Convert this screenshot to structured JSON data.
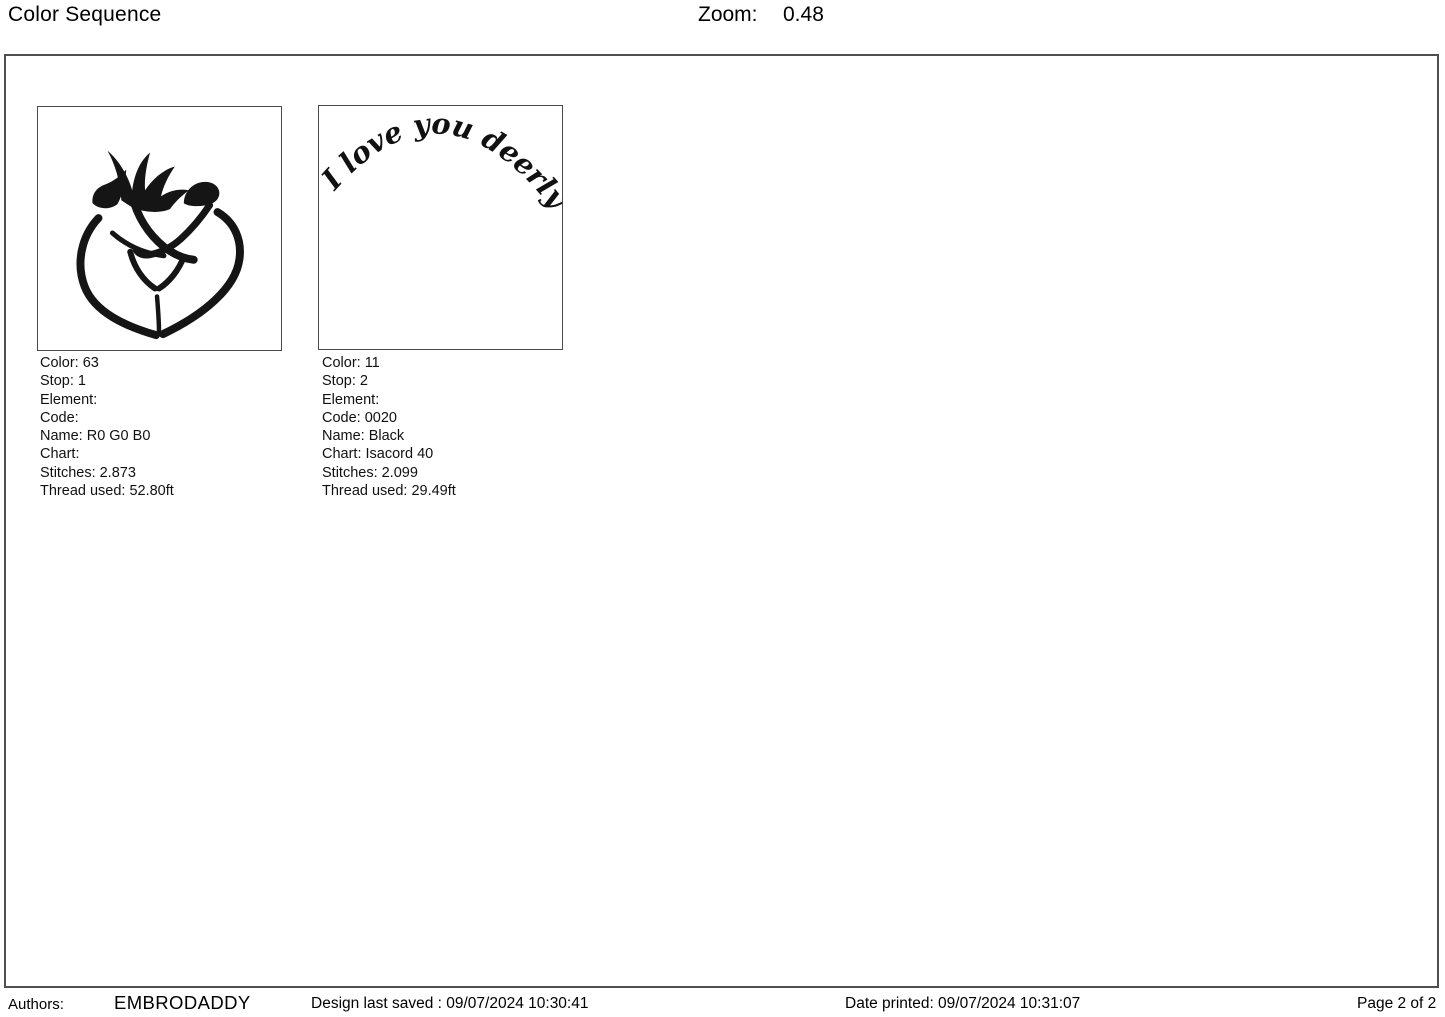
{
  "header": {
    "title": "Color Sequence",
    "zoom_label": "Zoom:",
    "zoom_value": "0.48"
  },
  "colors": {
    "ink": "#151515",
    "frame_border": "#4f4f4f",
    "thumb_border": "#4a4a4a"
  },
  "sequence": [
    {
      "design_name": "buck-and-doe-heart",
      "fields": [
        {
          "label": "Color:",
          "value": "63"
        },
        {
          "label": "Stop:",
          "value": "1"
        },
        {
          "label": "Element:",
          "value": ""
        },
        {
          "label": "Code:",
          "value": ""
        },
        {
          "label": "Name:",
          "value": "R0 G0 B0"
        },
        {
          "label": "Chart:",
          "value": ""
        },
        {
          "label": "Stitches:",
          "value": "2.873"
        },
        {
          "label": "Thread used:",
          "value": "52.80ft"
        }
      ]
    },
    {
      "design_name": "i-love-you-deerly-arc-text",
      "arc_text": "I love you deerly",
      "fields": [
        {
          "label": "Color:",
          "value": "11"
        },
        {
          "label": "Stop:",
          "value": "2"
        },
        {
          "label": "Element:",
          "value": ""
        },
        {
          "label": "Code:",
          "value": "0020"
        },
        {
          "label": "Name:",
          "value": "Black"
        },
        {
          "label": "Chart:",
          "value": "Isacord 40"
        },
        {
          "label": "Stitches:",
          "value": "2.099"
        },
        {
          "label": "Thread used:",
          "value": "29.49ft"
        }
      ]
    }
  ],
  "footer": {
    "authors_label": "Authors:",
    "author_name": "EMBRODADDY",
    "design_saved": "Design last saved : 09/07/2024 10:30:41",
    "date_printed": "Date printed: 09/07/2024 10:31:07",
    "page": "Page 2 of 2"
  }
}
